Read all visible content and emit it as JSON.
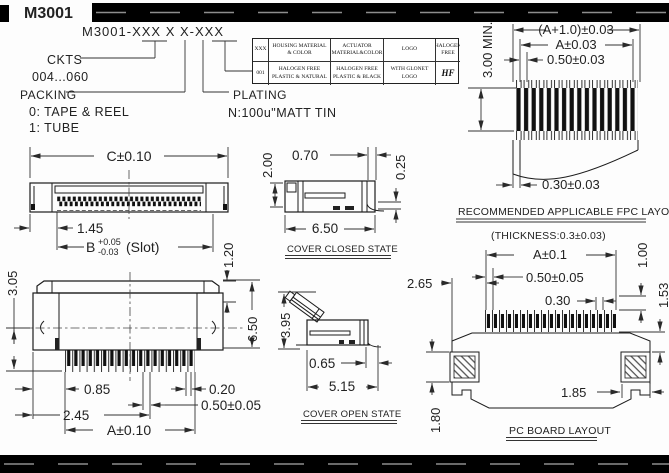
{
  "header": {
    "model": "M3001"
  },
  "part_number": {
    "code": "M3001-XXX X X-XXX",
    "ckts_label": "CKTS",
    "ckts_range": "004...060",
    "packing_label": "PACKING",
    "packing_opt1": "0: TAPE & REEL",
    "packing_opt2": "1: TUBE",
    "plating_label": "PLATING",
    "plating_value": "N:100u\"MATT TIN"
  },
  "spec_table": {
    "headers": [
      "XXX",
      "HOUSING MATERIAL & COLOR",
      "ACTUATOR MATERIAL&COLOR",
      "LOGO",
      "HALOGEN FREE"
    ],
    "rows": [
      [
        "001",
        "HALOGEN FREE PLASTIC & NATURAL",
        "HALOGEN FREE PLASTIC & BLACK",
        "WITH GLONET LOGO",
        "HF"
      ]
    ]
  },
  "views": {
    "fpc": {
      "dim_overall": "(A+1.0)±0.03",
      "dim_a": "A±0.03",
      "dim_pitch": "0.50±0.03",
      "dim_height": "3.00 MIN.",
      "dim_margin": "0.30±0.03",
      "title": "RECOMMENDED APPLICABLE FPC LAYOUT",
      "subtitle": "(THICKNESS:0.3±0.03)"
    },
    "front": {
      "dim_c": "C±0.10",
      "dim_1_45": "1.45",
      "dim_b": "B",
      "dim_b_plus": "+0.05",
      "dim_b_minus": "-0.03",
      "dim_b_suffix": "(Slot)"
    },
    "side_closed": {
      "dim_2_00": "2.00",
      "dim_0_70": "0.70",
      "dim_0_25": "0.25",
      "dim_6_50": "6.50",
      "title": "COVER CLOSED STATE"
    },
    "top": {
      "dim_3_05": "3.05",
      "dim_1_20": "1.20",
      "dim_6_50": "6.50",
      "dim_0_85": "0.85",
      "dim_0_20": "0.20",
      "dim_2_45": "2.45",
      "dim_0_50": "0.50±0.05",
      "dim_a": "A±0.10"
    },
    "side_open": {
      "dim_3_95": "3.95",
      "dim_0_65": "0.65",
      "dim_5_15": "5.15",
      "title": "COVER OPEN STATE"
    },
    "pcb": {
      "dim_2_65": "2.65",
      "dim_a": "A±0.1",
      "dim_0_50": "0.50±0.05",
      "dim_0_30": "0.30",
      "dim_1_00": "1.00",
      "dim_1_53": "1.53",
      "dim_1_85": "1.85",
      "dim_1_80": "1.80",
      "title": "PC BOARD LAYOUT"
    }
  },
  "colors": {
    "ink": "#1c1c1c",
    "bar": "#000000"
  }
}
